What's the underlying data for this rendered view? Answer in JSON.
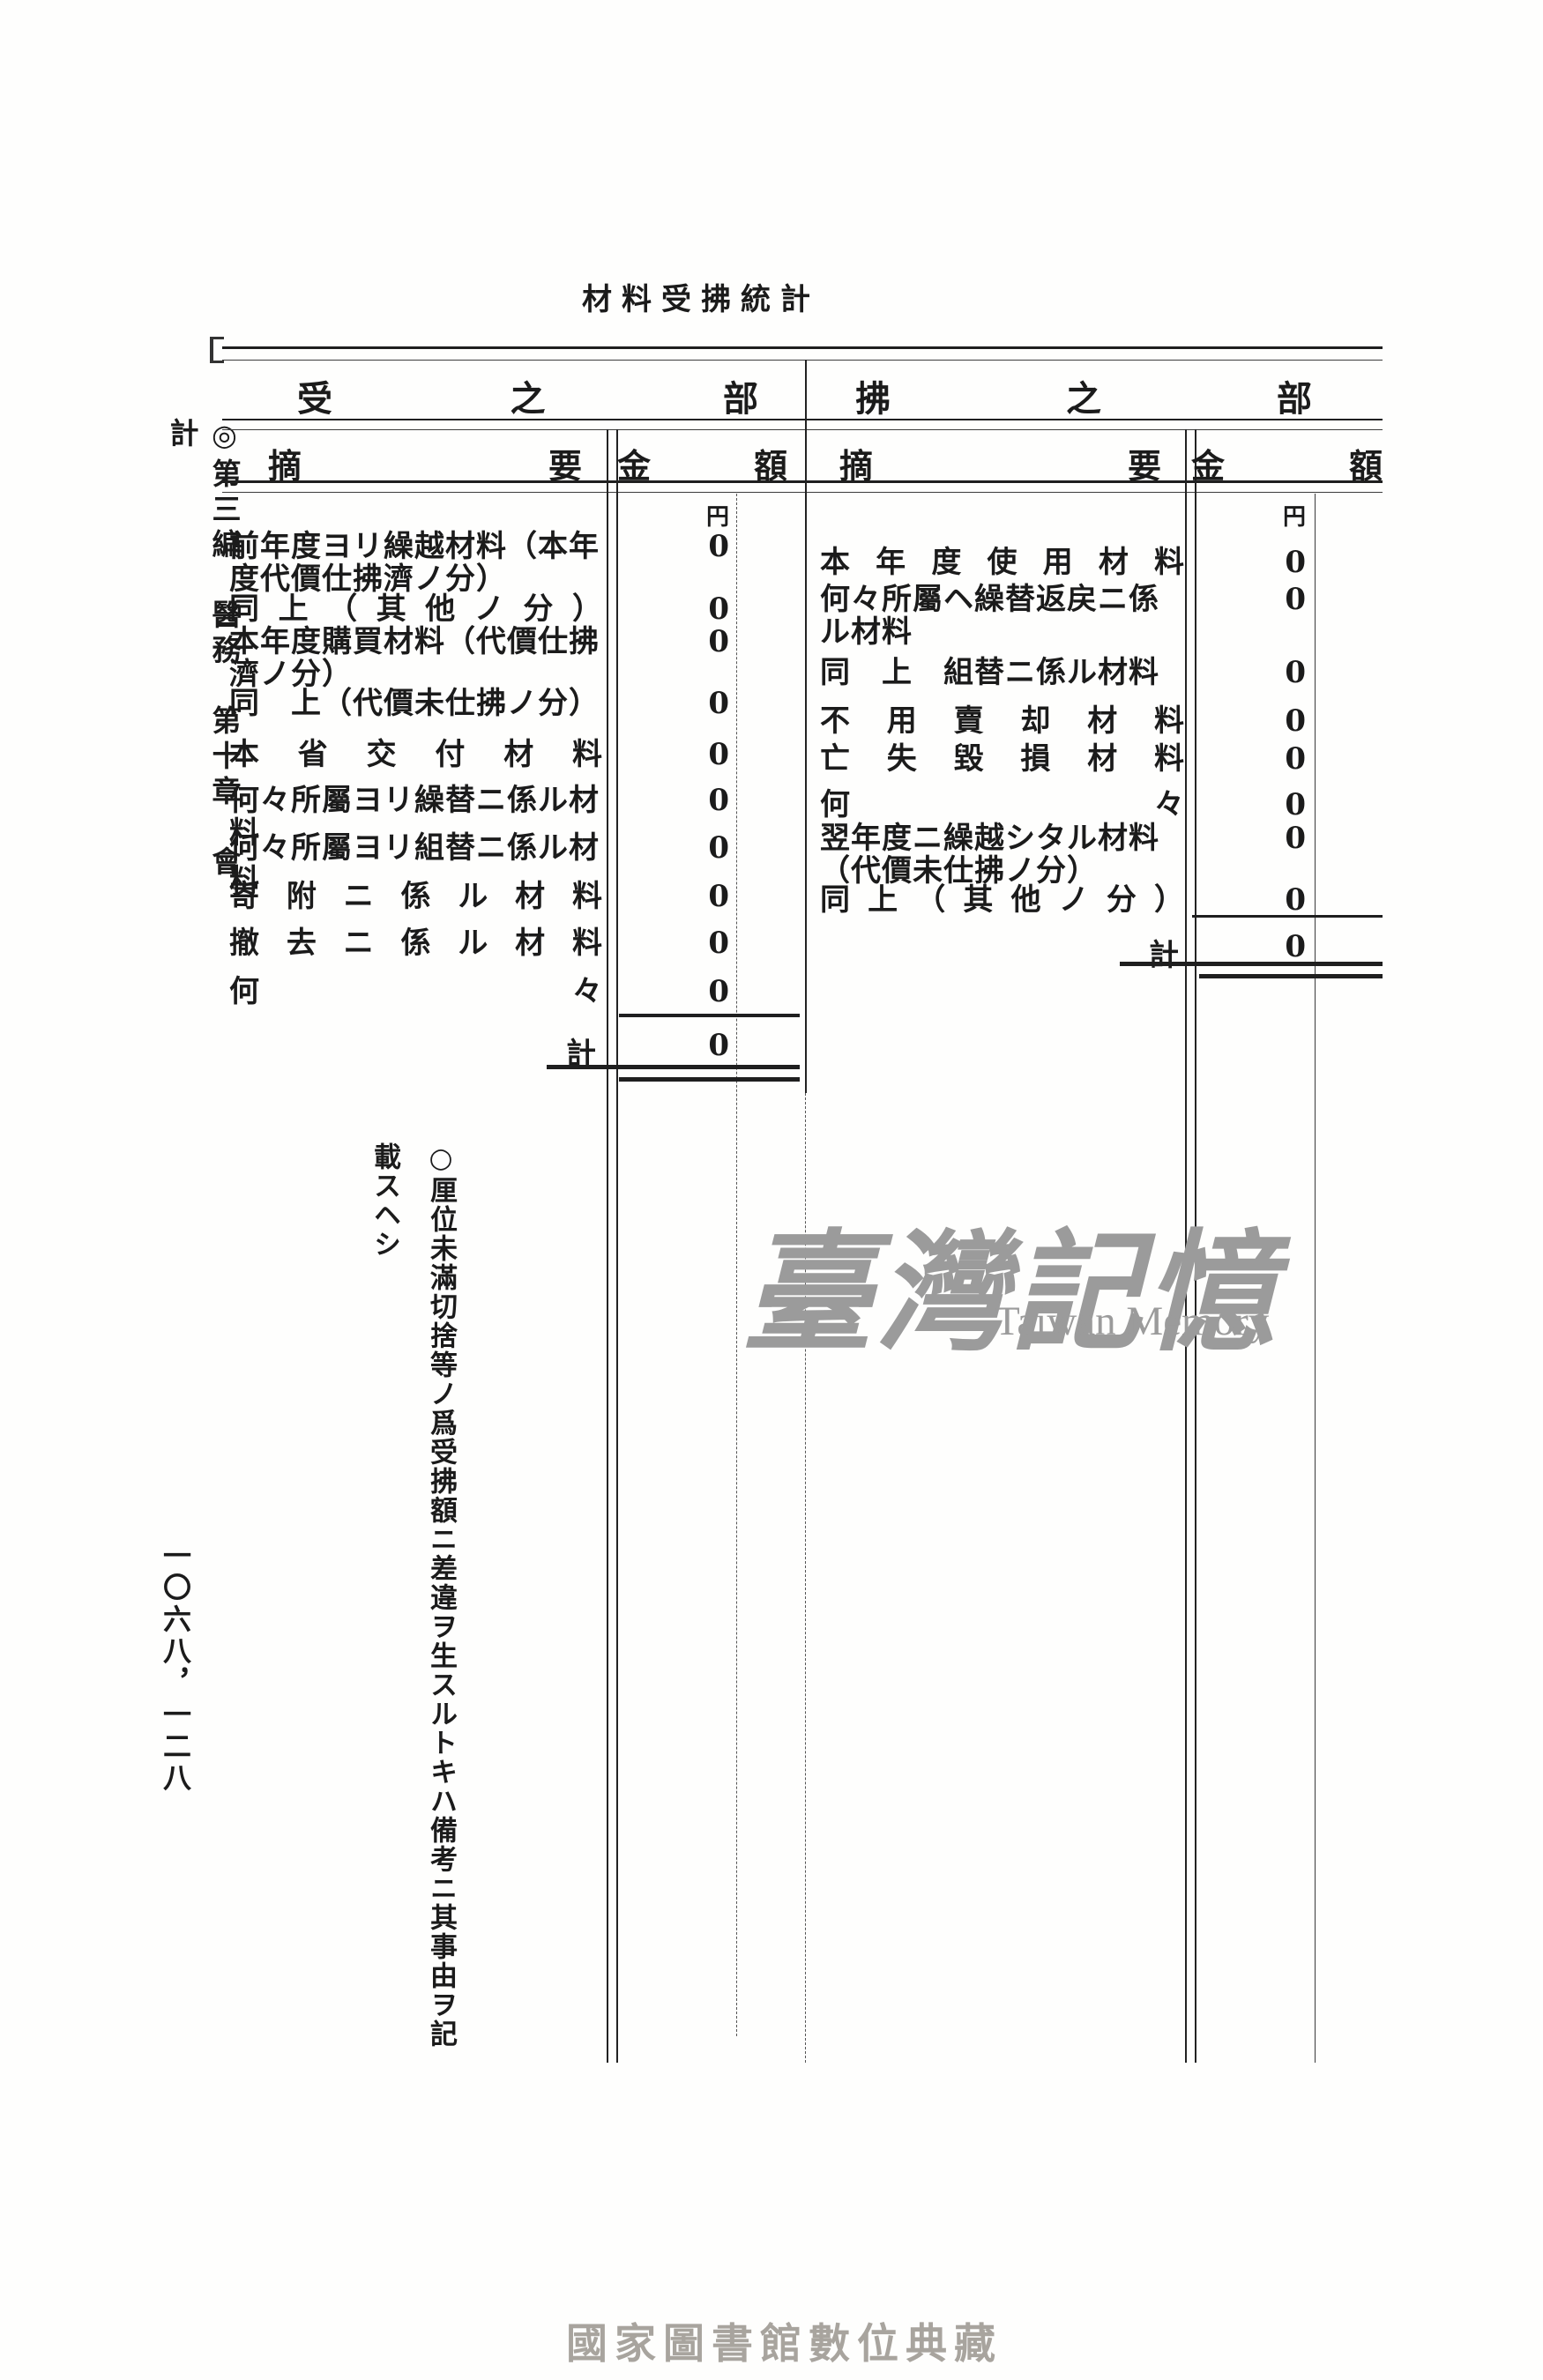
{
  "page": {
    "title": "材料受拂統計",
    "sidebar_heading": "◎第三編　醫務　第十章　會計",
    "page_numbers": "一〇六八，一二八",
    "footer_caption": "國家圖書館數位典藏"
  },
  "note": "○厘位未滿切捨等ノ爲受拂額ニ差違ヲ生スルトキハ備考ニ其事由ヲ記載スヘシ",
  "watermark": {
    "cjk": "臺灣記憶",
    "latin": "Taiwan Memory",
    "color": "#9b9b9b"
  },
  "table": {
    "currency_unit": "円",
    "sections": [
      {
        "title": "受之部",
        "columns": {
          "summary": "摘要",
          "amount": "金額"
        },
        "rows": [
          {
            "label": "前年度ヨリ繰越材料（本年度代價仕拂濟ノ分）",
            "value": "0"
          },
          {
            "label": "同上（其他ノ分）",
            "value": "0"
          },
          {
            "label": "本年度購買材料（代價仕拂濟ノ分）",
            "value": "0"
          },
          {
            "label": "同　上（代價未仕拂ノ分）",
            "value": "0"
          },
          {
            "label": "本省交付材料",
            "value": "0"
          },
          {
            "label": "何々所屬ヨリ繰替ニ係ル材料",
            "value": "0"
          },
          {
            "label": "何々所屬ヨリ組替ニ係ル材料",
            "value": "0"
          },
          {
            "label": "寄附ニ係ル材料",
            "value": "0"
          },
          {
            "label": "撤去ニ係ル材料",
            "value": "0"
          },
          {
            "label": "何々",
            "value": "0"
          }
        ],
        "total": {
          "label": "計",
          "value": "0"
        }
      },
      {
        "title": "拂之部",
        "columns": {
          "summary": "摘要",
          "amount": "金額"
        },
        "rows": [
          {
            "label": "本年度使用材料",
            "value": "0"
          },
          {
            "label": "何々所屬ヘ繰替返戻ニ係ル材料",
            "value": "0"
          },
          {
            "label": "同　上　組替ニ係ル材料",
            "value": "0"
          },
          {
            "label": "不用賣却材料",
            "value": "0"
          },
          {
            "label": "亡失毀損材料",
            "value": "0"
          },
          {
            "label": "何々",
            "value": "0"
          },
          {
            "label": "翌年度ニ繰越シタル材料（代價未仕拂ノ分）",
            "value": "0"
          },
          {
            "label": "同上（其他ノ分）",
            "value": "0"
          }
        ],
        "total": {
          "label": "計",
          "value": "0"
        }
      }
    ]
  }
}
